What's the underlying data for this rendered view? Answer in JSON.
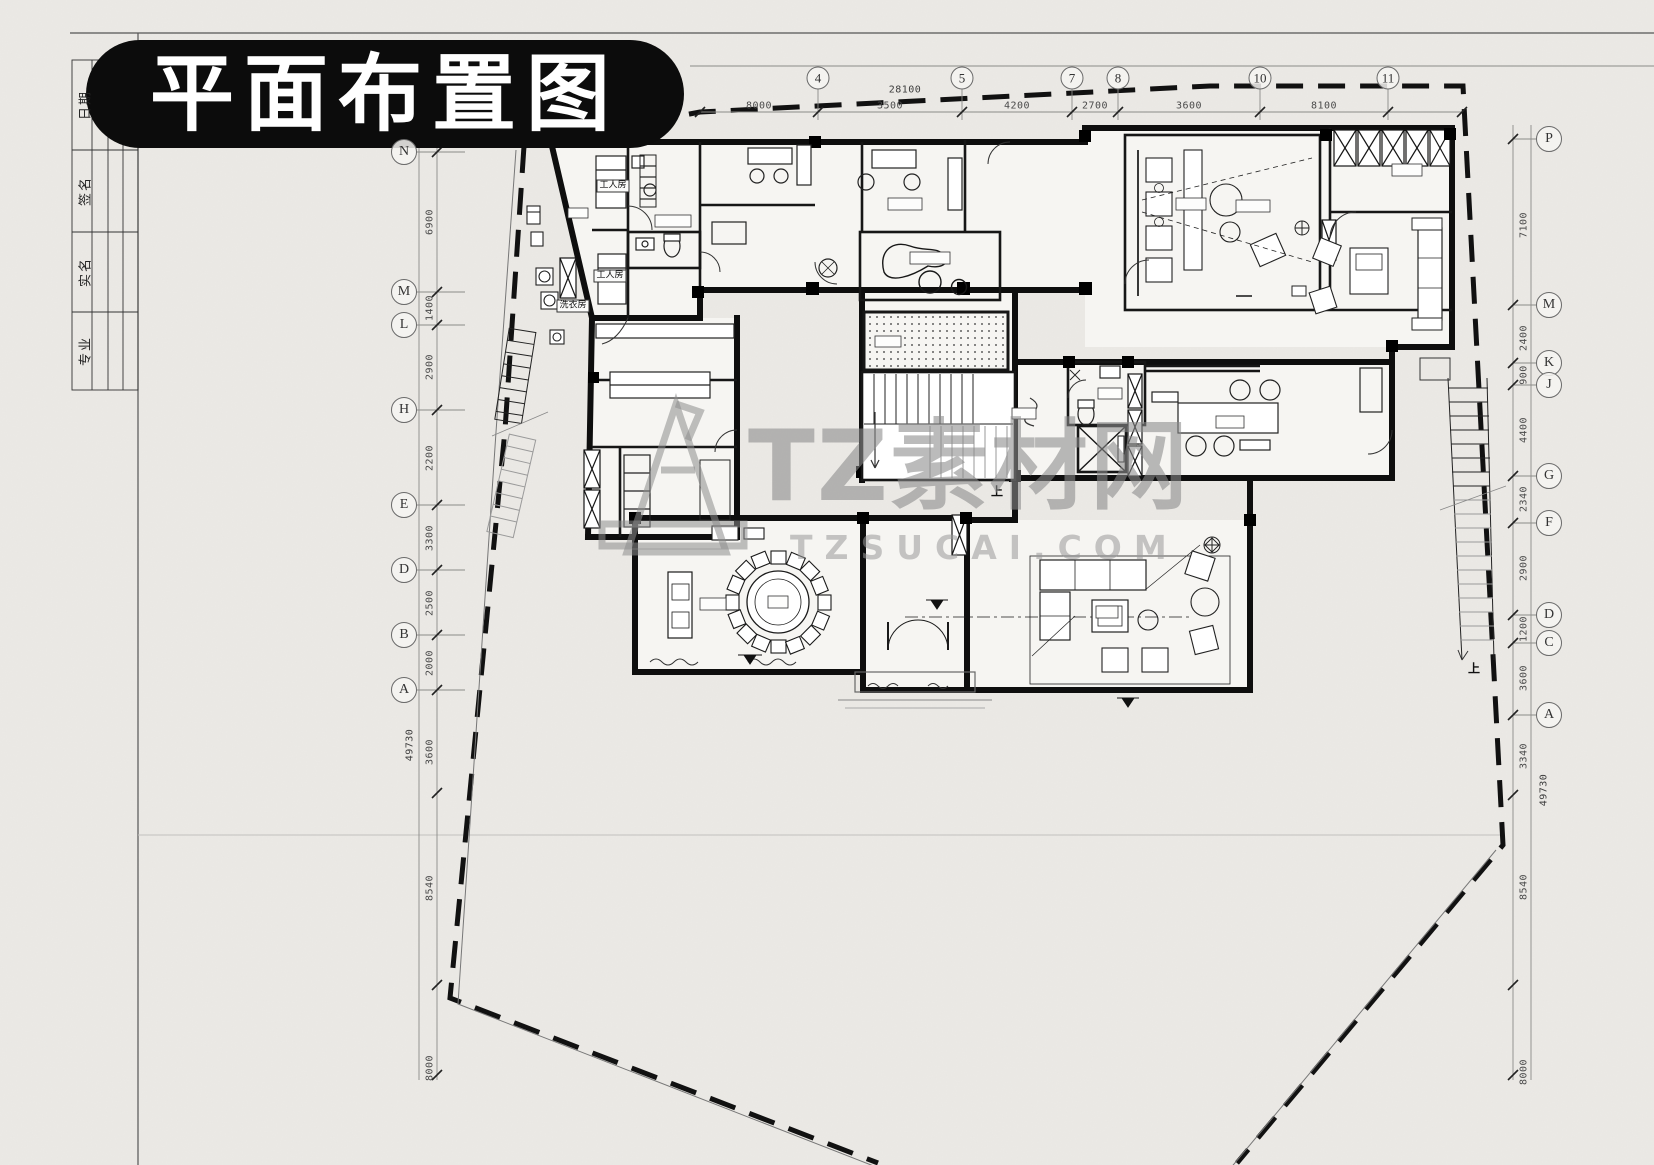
{
  "title": "平面布置图",
  "title_block": {
    "rows": [
      {
        "label": "日期",
        "y": 105
      },
      {
        "label": "签名",
        "y": 191
      },
      {
        "label": "实名",
        "y": 272
      },
      {
        "label": "专业",
        "y": 351
      }
    ]
  },
  "watermark": {
    "brand": "TZ素材网",
    "domain": "TZSUCAI.COM"
  },
  "colors": {
    "paper": "#ECEAE6",
    "ink": "#141414",
    "watermark_gray": "#8b8b8b",
    "pill_black": "#0c0c0c"
  },
  "plan_labels": [
    {
      "text": "工人房",
      "x": 613,
      "y": 186,
      "boxed": true
    },
    {
      "text": "工人房",
      "x": 610,
      "y": 276,
      "boxed": true
    },
    {
      "text": "洗衣房",
      "x": 573,
      "y": 306,
      "boxed": true
    },
    {
      "text": "上",
      "x": 997,
      "y": 492,
      "boxed": false
    },
    {
      "text": "上",
      "x": 1474,
      "y": 669,
      "boxed": false
    }
  ],
  "grid": {
    "top": {
      "y": 78,
      "bubbles": [
        {
          "label": "4",
          "x": 818
        },
        {
          "label": "5",
          "x": 962
        },
        {
          "label": "7",
          "x": 1072
        },
        {
          "label": "8",
          "x": 1118
        },
        {
          "label": "10",
          "x": 1260
        },
        {
          "label": "11",
          "x": 1388
        }
      ],
      "dims": [
        {
          "text": "8000",
          "x": 759,
          "y": 106
        },
        {
          "text": "3500",
          "x": 890,
          "y": 106
        },
        {
          "text": "4200",
          "x": 1017,
          "y": 106
        },
        {
          "text": "2700",
          "x": 1095,
          "y": 106
        },
        {
          "text": "3600",
          "x": 1189,
          "y": 106
        },
        {
          "text": "8100",
          "x": 1324,
          "y": 106
        }
      ],
      "total": {
        "text": "28100",
        "x": 905,
        "y": 90
      }
    },
    "left": {
      "x": 404,
      "bubbles": [
        {
          "label": "N",
          "y": 152
        },
        {
          "label": "M",
          "y": 292
        },
        {
          "label": "L",
          "y": 325
        },
        {
          "label": "H",
          "y": 410
        },
        {
          "label": "E",
          "y": 505
        },
        {
          "label": "D",
          "y": 570
        },
        {
          "label": "B",
          "y": 635
        },
        {
          "label": "A",
          "y": 690
        }
      ],
      "dims": [
        {
          "text": "6900",
          "y": 222
        },
        {
          "text": "1400",
          "y": 308
        },
        {
          "text": "2900",
          "y": 367
        },
        {
          "text": "2200",
          "y": 458
        },
        {
          "text": "3300",
          "y": 538
        },
        {
          "text": "2500",
          "y": 603
        },
        {
          "text": "2000",
          "y": 663
        },
        {
          "text": "3600",
          "y": 752
        },
        {
          "text": "8540",
          "y": 888
        },
        {
          "text": "8000",
          "y": 1068
        }
      ],
      "total": {
        "text": "49730",
        "y": 745
      }
    },
    "right": {
      "x": 1549,
      "bubbles": [
        {
          "label": "P",
          "y": 139
        },
        {
          "label": "M",
          "y": 305
        },
        {
          "label": "K",
          "y": 363
        },
        {
          "label": "J",
          "y": 385
        },
        {
          "label": "G",
          "y": 476
        },
        {
          "label": "F",
          "y": 523
        },
        {
          "label": "D",
          "y": 615
        },
        {
          "label": "C",
          "y": 643
        },
        {
          "label": "A",
          "y": 715
        }
      ],
      "dims": [
        {
          "text": "7100",
          "y": 225
        },
        {
          "text": "2400",
          "y": 338
        },
        {
          "text": "900",
          "y": 375
        },
        {
          "text": "4400",
          "y": 430
        },
        {
          "text": "2340",
          "y": 499
        },
        {
          "text": "2900",
          "y": 568
        },
        {
          "text": "1200",
          "y": 629
        },
        {
          "text": "3600",
          "y": 678
        },
        {
          "text": "3340",
          "y": 756
        },
        {
          "text": "8540",
          "y": 887
        },
        {
          "text": "8000",
          "y": 1072
        }
      ],
      "total": {
        "text": "49730",
        "y": 790
      }
    }
  }
}
